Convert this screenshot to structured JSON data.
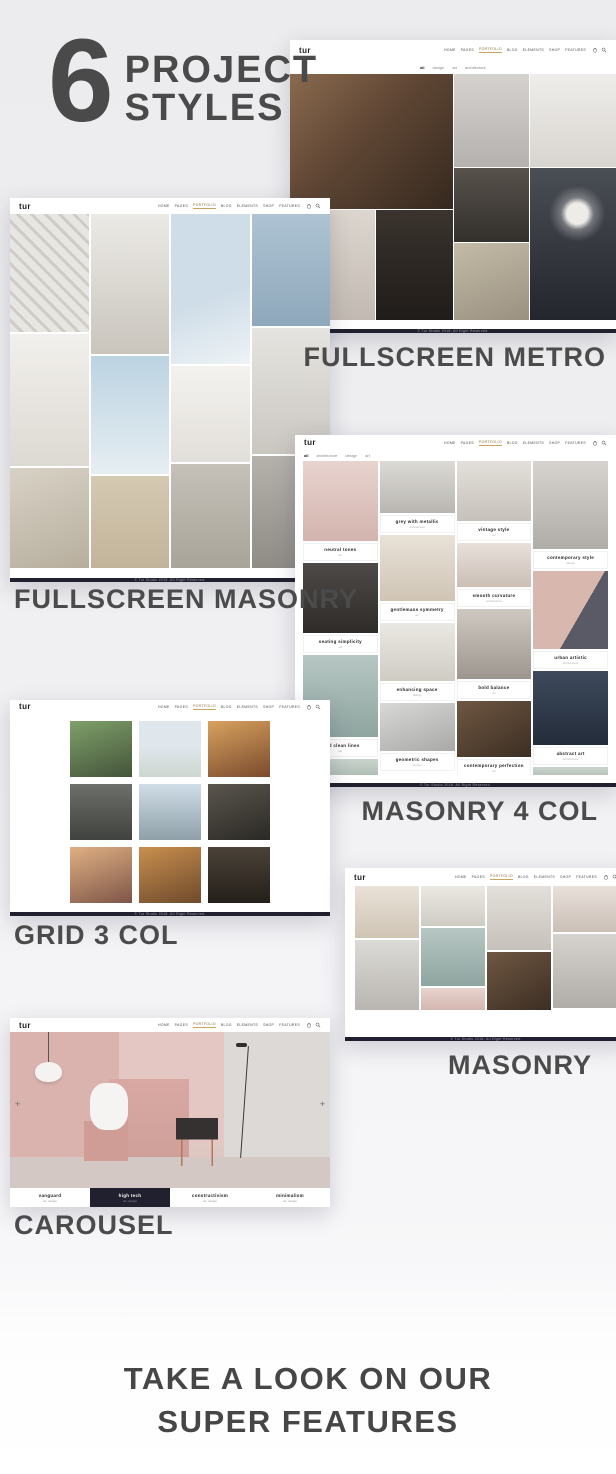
{
  "hero": {
    "number": "6",
    "title_line1": "PROJECT",
    "title_line2": "STYLES"
  },
  "shared": {
    "logo": "tur",
    "nav_items": [
      "HOME",
      "PAGES",
      "PORTFOLIO",
      "BLOG",
      "ELEMENTS",
      "SHOP",
      "FEATURES"
    ],
    "nav_active_index": 2,
    "copyright": "© Tur Studio 2018. All Right Reserved.",
    "colors": {
      "accent": "#c8a45f",
      "footer_bar": "#20202e",
      "heading_text": "#4a4a4a"
    }
  },
  "sections": {
    "metro": {
      "label": "FULLSCREEN METRO",
      "filters": [
        "all",
        "design",
        "art",
        "architecture"
      ],
      "filter_active_index": 0
    },
    "fullscreen_masonry": {
      "label": "FULLSCREEN MASONRY"
    },
    "masonry4": {
      "label": "MASONRY 4 COL",
      "filters": [
        "all",
        "architecture",
        "design",
        "art"
      ],
      "filter_active_index": 0,
      "projects": [
        {
          "title": "neutral tones",
          "category": "art"
        },
        {
          "title": "seating simplicity",
          "category": "art"
        },
        {
          "title": "bold clean lines",
          "category": "art"
        },
        {
          "title": "grey with metallic",
          "category": "architecture"
        },
        {
          "title": "gentlemans symmetry",
          "category": "art"
        },
        {
          "title": "enhancing space",
          "category": "design"
        },
        {
          "title": "geometric shapes",
          "category": "design"
        },
        {
          "title": "vintage style",
          "category": "art"
        },
        {
          "title": "smooth curvature",
          "category": "architecture"
        },
        {
          "title": "bold balance",
          "category": "art"
        },
        {
          "title": "contemporary perfection",
          "category": "art"
        },
        {
          "title": "contemporary style",
          "category": "design"
        },
        {
          "title": "urban artistic",
          "category": "architecture"
        },
        {
          "title": "abstract art",
          "category": "architecture"
        }
      ]
    },
    "grid3": {
      "label": "GRID 3 COL"
    },
    "masonry": {
      "label": "MASONRY"
    },
    "carousel": {
      "label": "CAROUSEL",
      "active_index": 1,
      "prev_glyph": "+",
      "next_glyph": "+",
      "slides": [
        {
          "title": "vanguard",
          "meta": "art, design"
        },
        {
          "title": "high tech",
          "meta": "art, design"
        },
        {
          "title": "constructivism",
          "meta": "art, design"
        },
        {
          "title": "minimalism",
          "meta": "art, design"
        }
      ]
    }
  },
  "footer_heading": {
    "line1": "TAKE A LOOK ON OUR",
    "line2": "SUPER FEATURES"
  }
}
